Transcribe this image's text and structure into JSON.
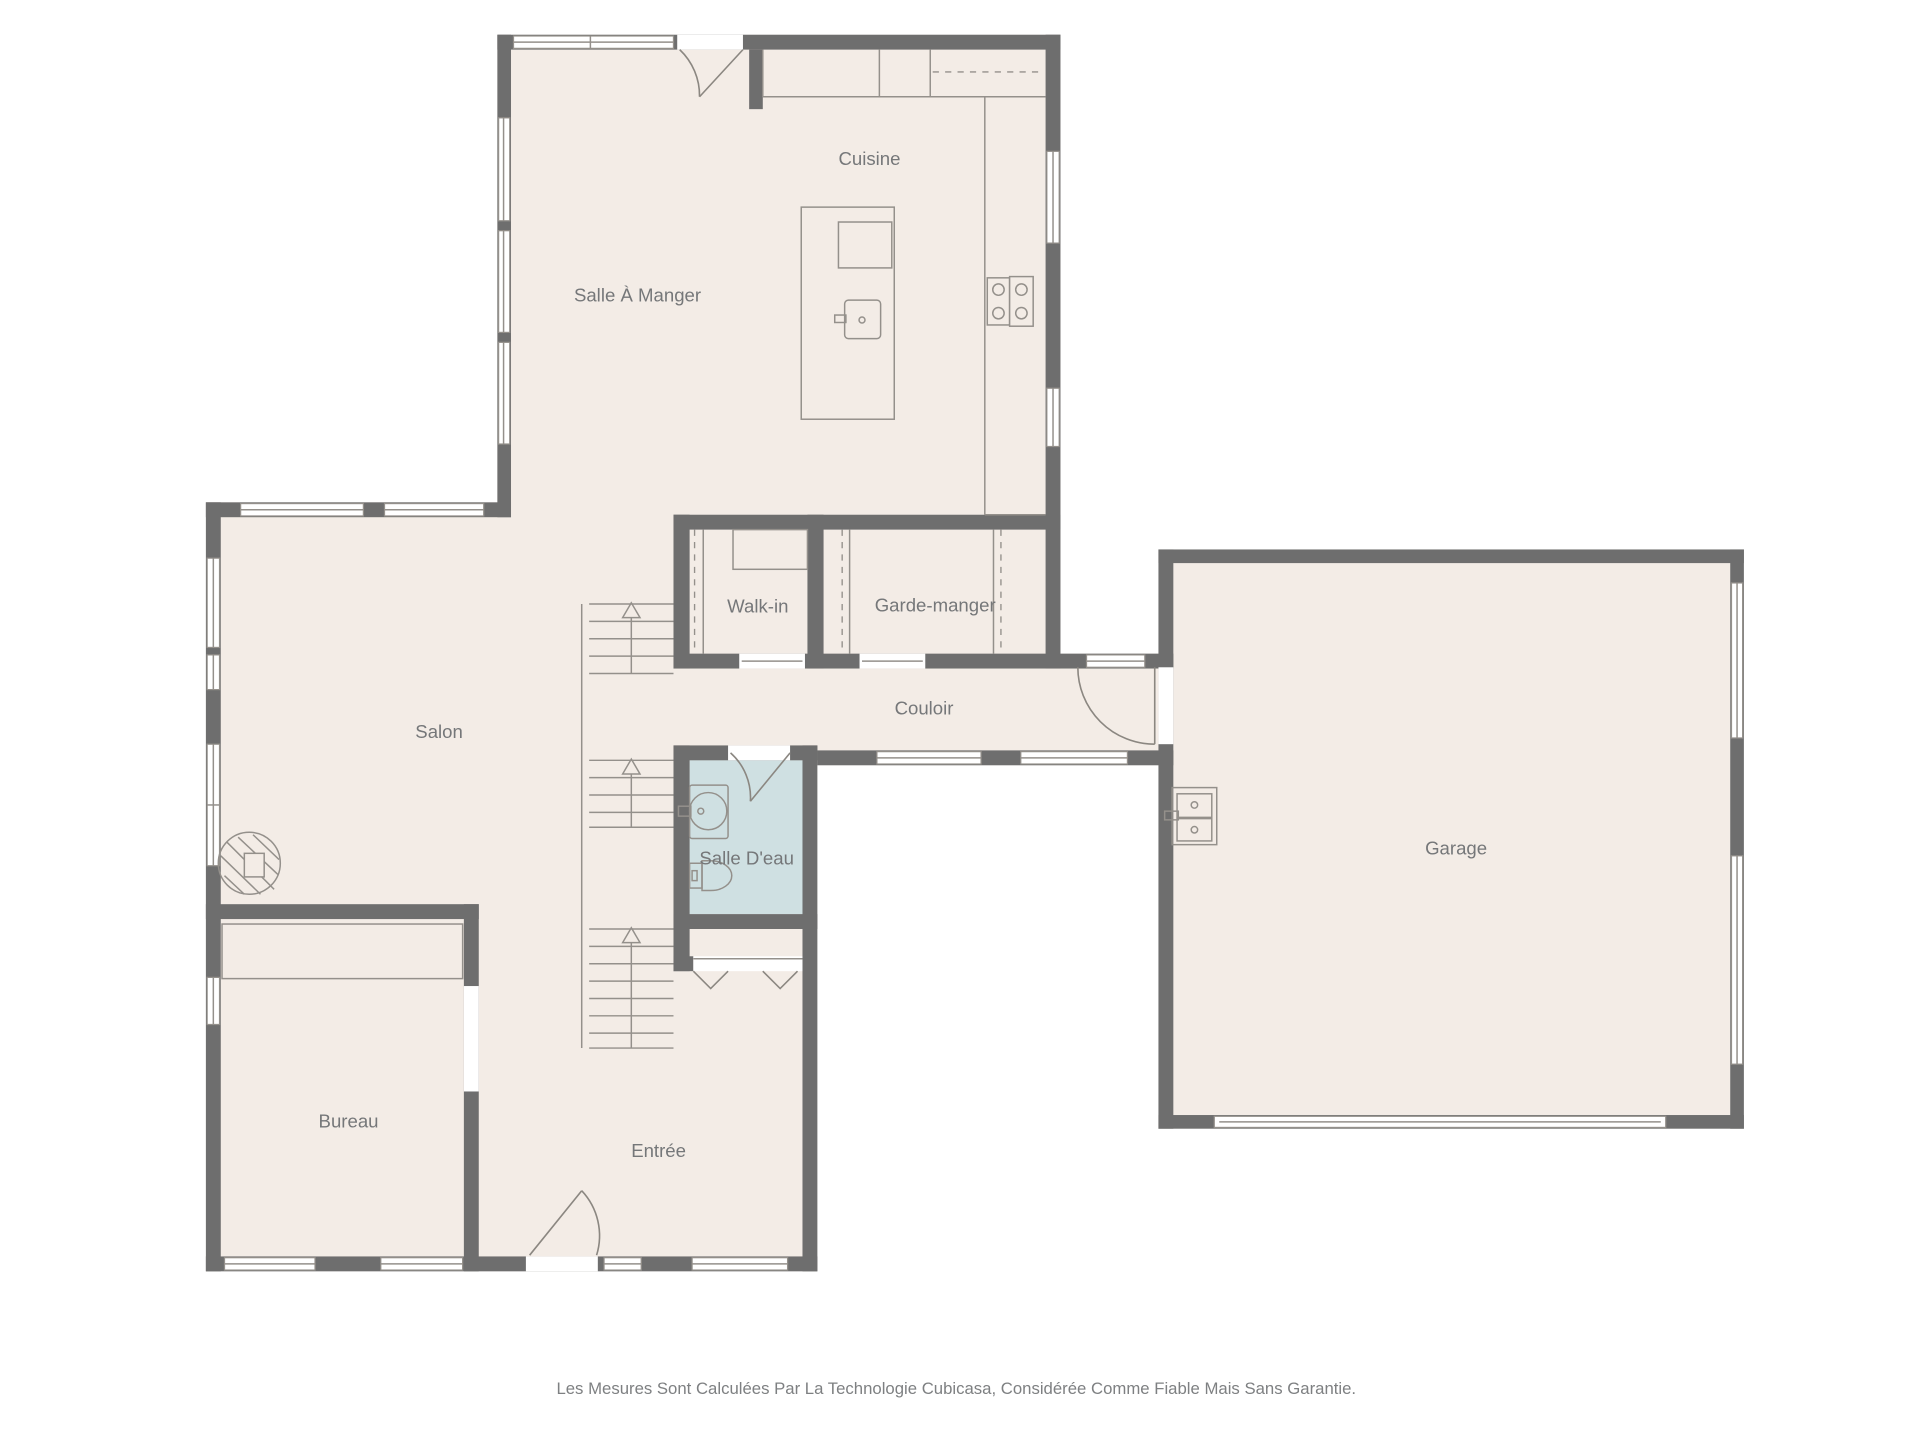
{
  "rooms": {
    "cuisine": "Cuisine",
    "salle_a_manger": "Salle À Manger",
    "walk_in": "Walk-in",
    "garde_manger": "Garde-manger",
    "couloir": "Couloir",
    "salon": "Salon",
    "salle_deau": "Salle D'eau",
    "garage": "Garage",
    "bureau": "Bureau",
    "entree": "Entrée"
  },
  "footer": {
    "disclaimer": "Les Mesures Sont Calculées Par La Technologie Cubicasa, Considérée Comme Fiable Mais Sans Garantie."
  },
  "colors": {
    "wall": "#6e6e6e",
    "room_fill": "#f3ece6",
    "wet_room_fill": "#cfe0e2",
    "line": "#94908b",
    "label_text": "#757779",
    "background": "#ffffff"
  }
}
